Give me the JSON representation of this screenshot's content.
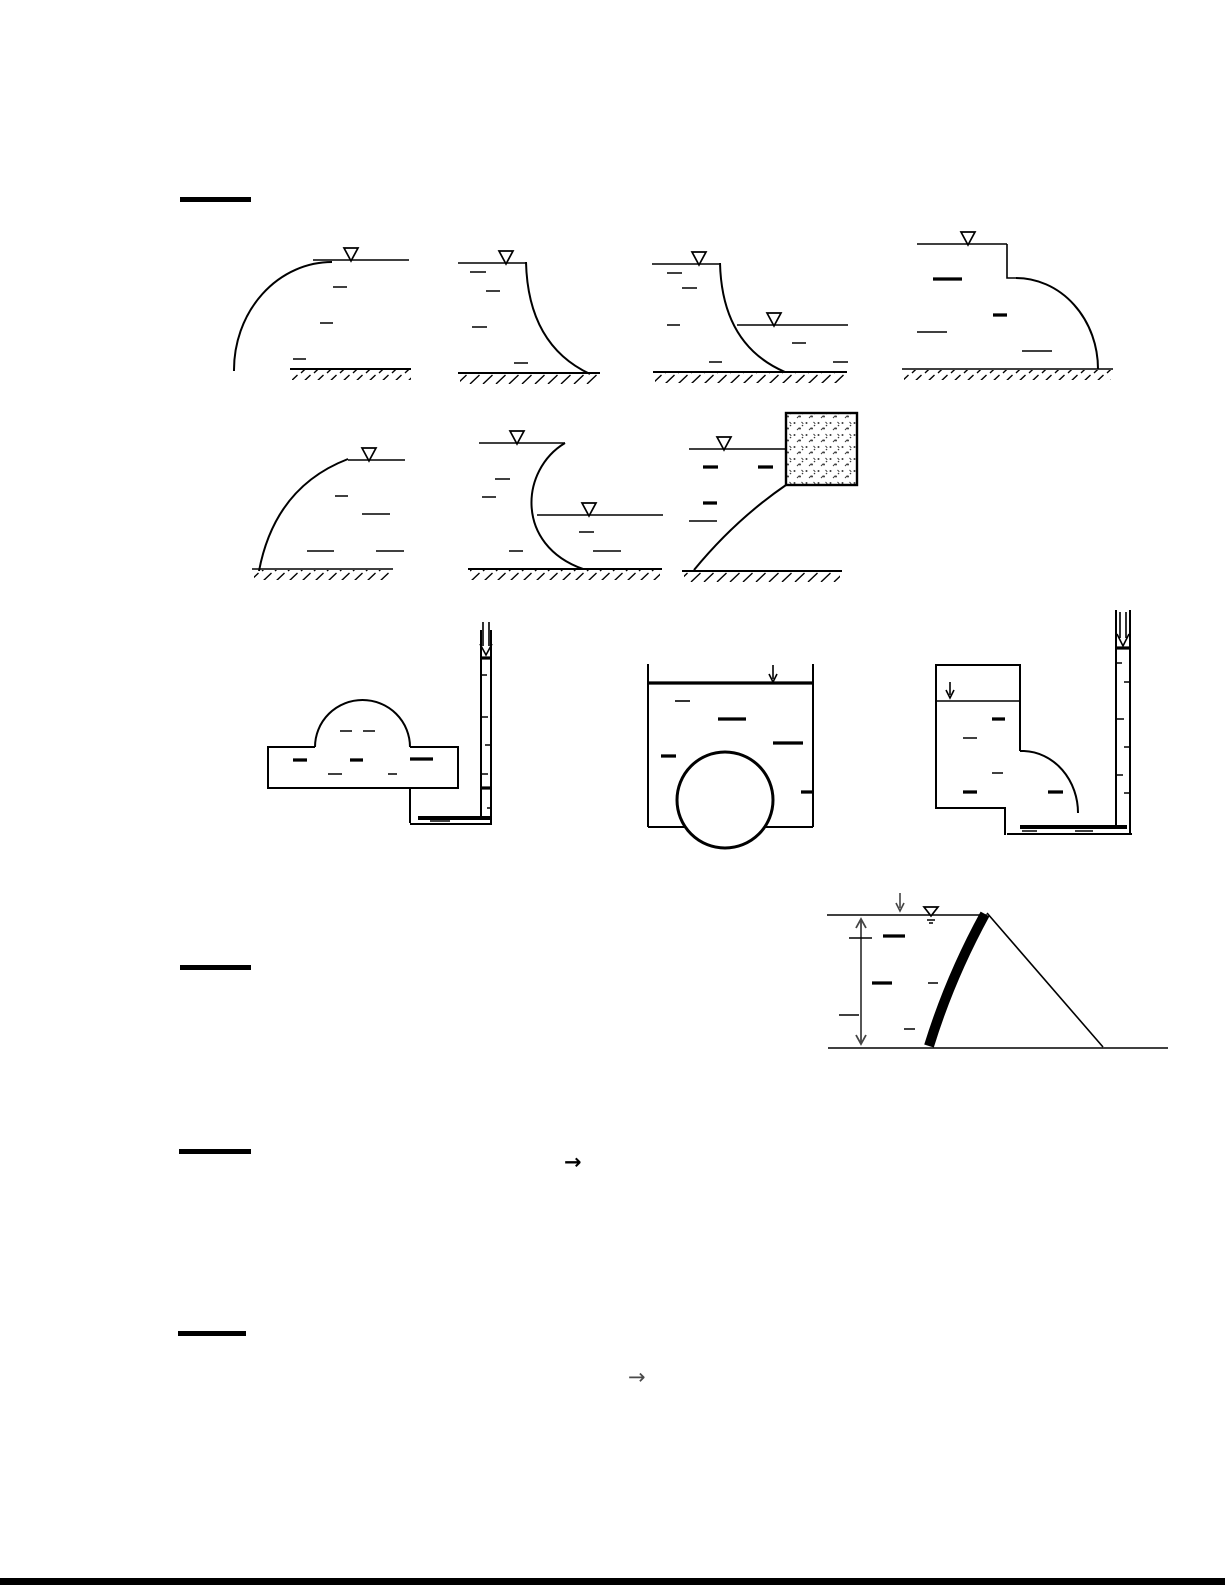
{
  "page": {
    "background_color": "#ffffff",
    "ink_color": "#000000",
    "annotation_color": "#444444"
  },
  "symbols": {
    "water_surface_marker": "▽",
    "down_arrow": "↓",
    "right_arrow": "→"
  },
  "headings": {
    "count": 4,
    "note_visible_text": ""
  }
}
